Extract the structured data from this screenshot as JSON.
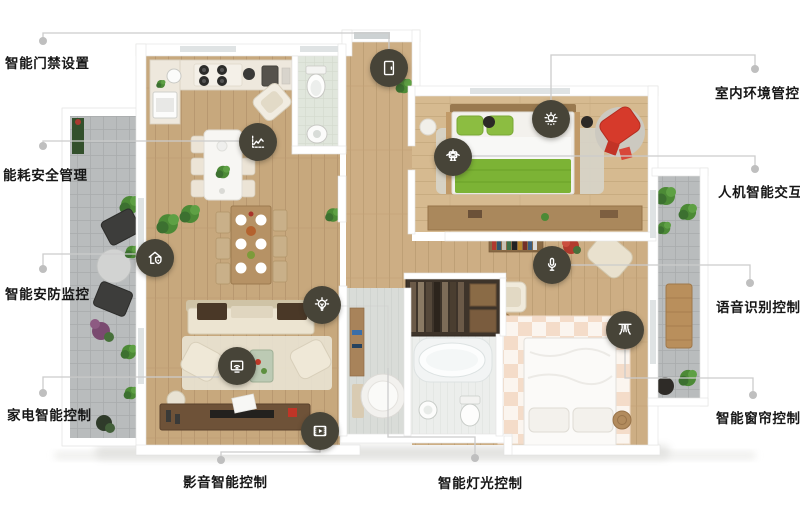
{
  "page": {
    "kind": "smart-home floor-plan infographic",
    "background": "#ffffff"
  },
  "colors": {
    "hotspot_bg": "#474438",
    "callout_line": "#cccccc",
    "callout_dot": "#bfbfbf",
    "label_text": "#161616",
    "wood_floor": "#c7a87d",
    "bed_green": "#7cb335",
    "accent_red": "#d63a2b",
    "paver_gray": "#b9bcbd"
  },
  "features": [
    {
      "label": "智能门禁设置",
      "icon": "door-lock-icon"
    },
    {
      "label": "能耗安全管理",
      "icon": "energy-chart-icon"
    },
    {
      "label": "智能安防监控",
      "icon": "house-shield-icon"
    },
    {
      "label": "家电智能控制",
      "icon": "tv-wifi-icon"
    },
    {
      "label": "影音智能控制",
      "icon": "film-media-icon"
    },
    {
      "label": "智能灯光控制",
      "icon": "light-bulb-icon"
    },
    {
      "label": "室内环境管控",
      "icon": "sun-air-icon"
    },
    {
      "label": "人机智能交互",
      "icon": "robot-icon"
    },
    {
      "label": "语音识别控制",
      "icon": "microphone-icon"
    },
    {
      "label": "智能窗帘控制",
      "icon": "curtain-icon"
    }
  ]
}
